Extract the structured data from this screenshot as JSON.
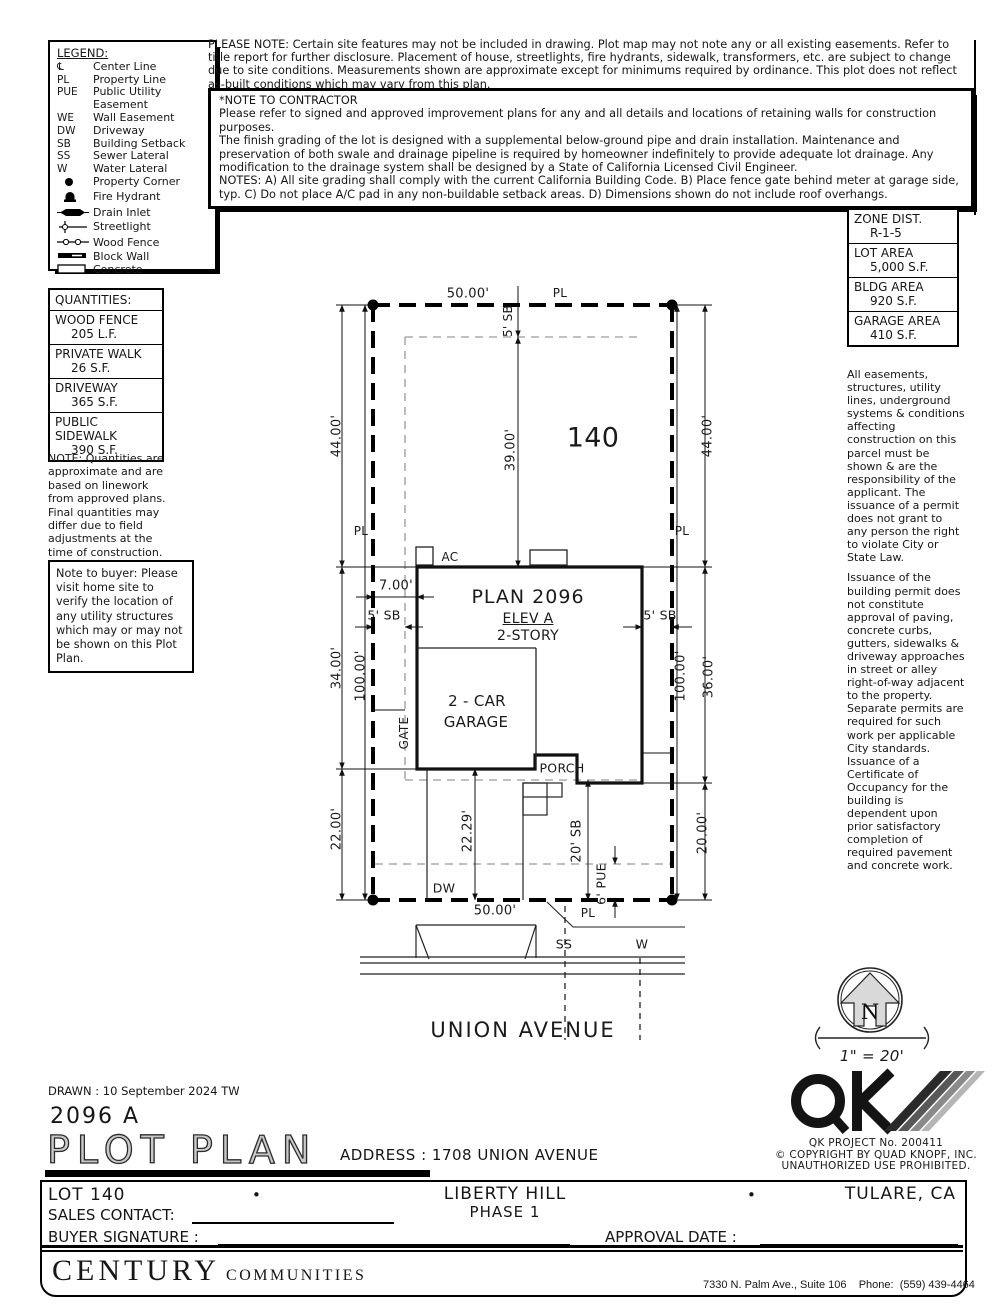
{
  "legend": {
    "title": "LEGEND:",
    "items": [
      {
        "sym": "℄",
        "label": "Center Line"
      },
      {
        "sym": "PL",
        "label": "Property Line"
      },
      {
        "sym": "PUE",
        "label": "Public Utility Easement"
      },
      {
        "sym": "WE",
        "label": "Wall Easement"
      },
      {
        "sym": "DW",
        "label": "Driveway"
      },
      {
        "sym": "SB",
        "label": "Building Setback"
      },
      {
        "sym": "SS",
        "label": "Sewer Lateral"
      },
      {
        "sym": "W",
        "label": "Water Lateral"
      },
      {
        "sym": "",
        "icon": "property-corner-icon",
        "label": "Property Corner"
      },
      {
        "sym": "",
        "icon": "fire-hydrant-icon",
        "label": "Fire Hydrant"
      },
      {
        "sym": "",
        "icon": "drain-inlet-icon",
        "label": "Drain Inlet"
      },
      {
        "sym": "",
        "icon": "streetlight-icon",
        "label": "Streetlight"
      },
      {
        "sym": "",
        "icon": "wood-fence-icon",
        "label": "Wood Fence"
      },
      {
        "sym": "",
        "icon": "block-wall-icon",
        "label": "Block Wall"
      },
      {
        "sym": "",
        "icon": "concrete-icon",
        "label": "Concrete"
      }
    ]
  },
  "top_note": "PLEASE NOTE:  Certain site features may not be included in drawing.  Plot map may not note any or all existing easements. Refer to title report for further disclosure.  Placement of house, streetlights, fire hydrants, sidewalk, transformers, etc. are subject to change due to site conditions.  Measurements shown are approximate except for minimums required by ordinance.  This plot does not reflect as-built conditions which may vary from this plan.",
  "contractor_note": {
    "title": "*NOTE TO CONTRACTOR",
    "p1": "Please refer to signed and approved improvement plans for any and all details and locations of retaining walls for construction purposes.",
    "p2": "The finish grading of the lot is designed with a supplemental below-ground pipe and drain installation.  Maintenance and preservation of both swale and drainage pipeline is required by homeowner indefinitely to provide adequate lot drainage.  Any modification to the drainage system shall be designed by a State of California Licensed Civil Engineer.",
    "p3": "NOTES:  A) All site grading shall comply with the current California Building Code.  B) Place fence gate behind meter at garage side, typ.  C) Do not place A/C pad in any non-buildable setback areas.  D) Dimensions shown do not include roof overhangs."
  },
  "zone_table": {
    "rows": [
      {
        "label": "ZONE DIST.",
        "value": "R-1-5"
      },
      {
        "label": "LOT AREA",
        "value": "5,000 S.F."
      },
      {
        "label": "BLDG AREA",
        "value": "920 S.F."
      },
      {
        "label": "GARAGE AREA",
        "value": "410 S.F."
      }
    ]
  },
  "quantities": {
    "title": "QUANTITIES:",
    "rows": [
      {
        "label": "WOOD FENCE",
        "value": "205 L.F."
      },
      {
        "label": "PRIVATE WALK",
        "value": "26 S.F."
      },
      {
        "label": "DRIVEWAY",
        "value": "365 S.F."
      },
      {
        "label": "PUBLIC SIDEWALK",
        "value": "390 S.F."
      }
    ],
    "note": "NOTE: Quantities are approximate and are based on linework from approved plans.  Final quantities may differ due to field adjustments at the time of construction."
  },
  "buyer_note": "Note to buyer:  Please visit home site to verify the location of any utility structures which may or may not be shown on this Plot Plan.",
  "right_column": {
    "p1": "All easements, structures, utility lines, underground systems & conditions affecting construction on this parcel must be shown & are the responsibility of the applicant. The issuance of a permit does not grant to any person the right to violate City or State Law.",
    "p2": "Issuance of the building permit does not constitute approval of paving, concrete curbs, gutters, sidewalks & driveway approaches in street or alley right-of-way adjacent to the property. Separate permits are required for such work per applicable City standards. Issuance of a Certificate of Occupancy for the building is dependent upon prior satisfactory completion of required pavement and concrete work."
  },
  "plot": {
    "dim_top_50": "50.00'",
    "pl_top": "PL",
    "sb_top": "5' SB",
    "dim_mid_39": "39.00'",
    "lot_number": "140",
    "dim_left_44": "44.00'",
    "dim_right_44": "44.00'",
    "pl_left": "PL",
    "pl_right": "PL",
    "ac": "AC",
    "dim_7": "7.00'",
    "plan_title": "PLAN 2096",
    "elev": "ELEV A",
    "story": "2-STORY",
    "sb_left": "5' SB",
    "sb_right": "5' SB",
    "dim_left_34": "34.00'",
    "dim_left_100": "100.00'",
    "dim_right_100": "100.00'",
    "dim_right_36": "36.00'",
    "garage_l1": "2 - CAR",
    "garage_l2": "GARAGE",
    "gate": "GATE",
    "porch": "PORCH",
    "dim_left_22": "22.00'",
    "dim_2229": "22.29'",
    "sb_20": "20' SB",
    "pue_6": "6' PUE",
    "dim_right_20": "20.00'",
    "dw": "DW",
    "dim_bot_50": "50.00'",
    "pl_bottom": "PL",
    "ss": "SS",
    "w": "W",
    "street_name": "UNION AVENUE"
  },
  "compass": {
    "north": "N",
    "scale": "1\" = 20'"
  },
  "qk": {
    "project": "QK PROJECT No. 200411",
    "copyright": "©   COPYRIGHT BY QUAD KNOPF, INC.",
    "unauthorized": "UNAUTHORIZED USE PROHIBITED."
  },
  "title_block": {
    "drawn": "DRAWN :  10 September 2024   TW",
    "plan_no": "2096 A",
    "title": "PLOT PLAN",
    "address": "ADDRESS :   1708 UNION AVENUE"
  },
  "footer": {
    "lot": "LOT 140",
    "bullet": "•",
    "community": "LIBERTY HILL",
    "phase": "PHASE 1",
    "city": "TULARE, CA",
    "sales_label": "SALES CONTACT:",
    "buyer_label": "BUYER SIGNATURE :",
    "approval_label": "APPROVAL DATE :",
    "brand": "CENTURY",
    "brand2": "COMMUNITIES",
    "addr_line1": "7330 N. Palm Ave., Suite 106    Phone:  (559) 439-4464",
    "addr_line2": "Fresno, CA  93711"
  }
}
